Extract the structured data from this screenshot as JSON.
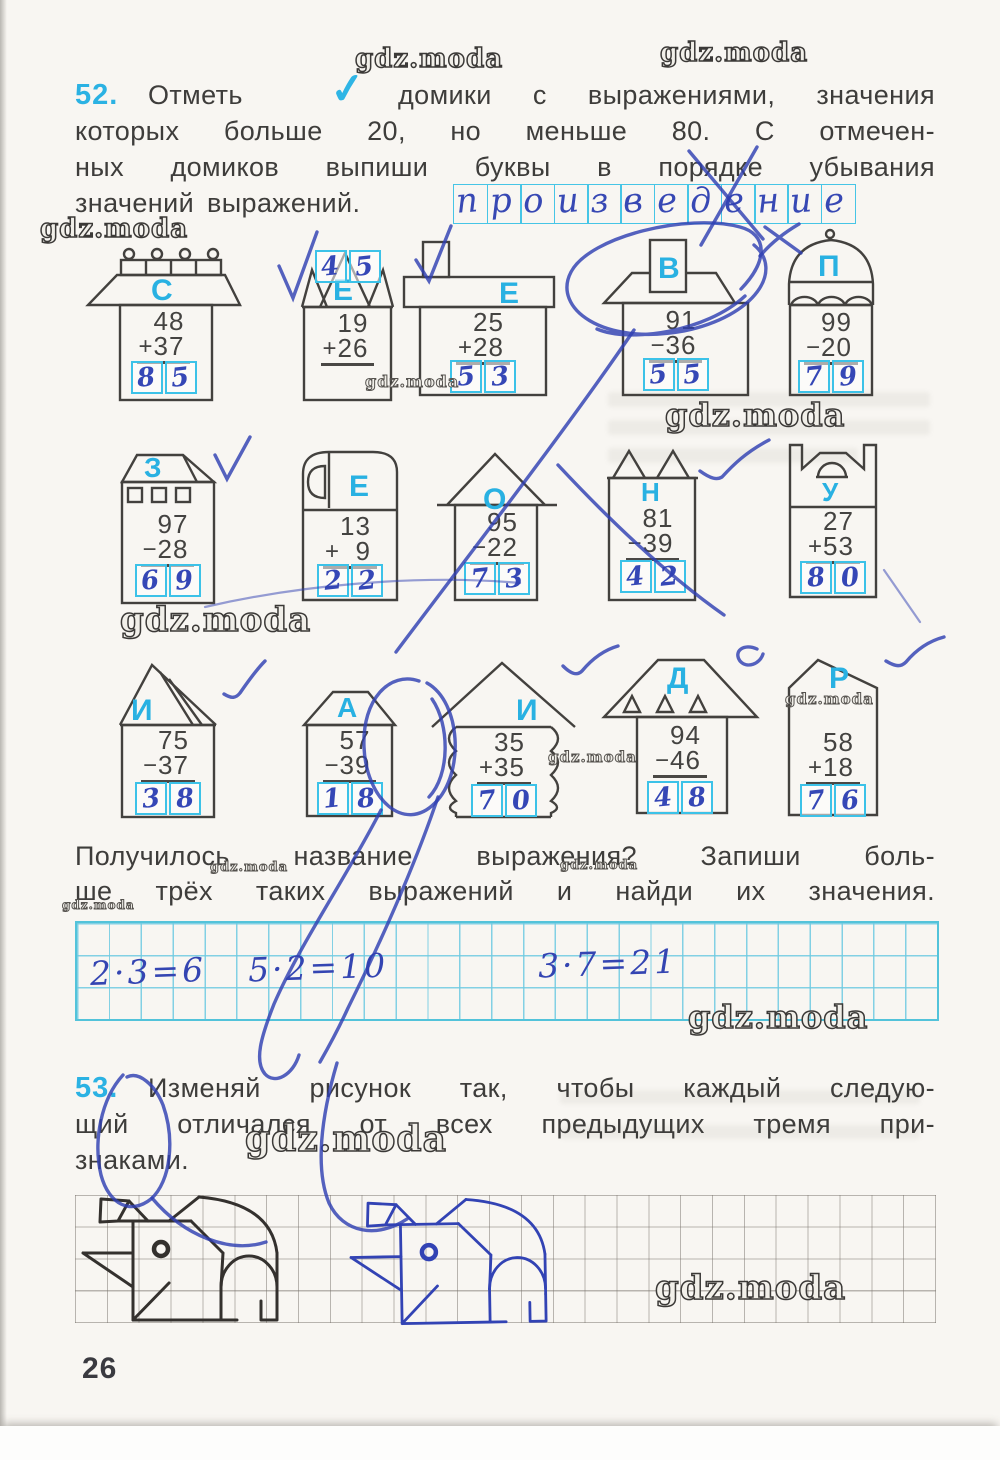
{
  "watermark": {
    "text": "gdz.moda"
  },
  "page": {
    "number": "26"
  },
  "task52": {
    "number": "52.",
    "word1": "Отметь",
    "check": "✓",
    "line1_rest": "домики с выражениями, значения",
    "line2": "которых больше 20, но меньше 80. С отмечен-",
    "line3": "ных домиков выпиши буквы в порядке убывания",
    "line4": "значений выражений.",
    "answer_letters": [
      "п",
      "р",
      "о",
      "и",
      "з",
      "в",
      "е",
      "д",
      "е",
      "н",
      "и",
      "е"
    ],
    "houses": [
      {
        "letter": "С",
        "sign": "+",
        "top": "48",
        "bottom": "37",
        "d1": "8",
        "d2": "5"
      },
      {
        "letter": "Е",
        "sign": "+",
        "top": "19",
        "bottom": "26",
        "d1": "4",
        "d2": "5"
      },
      {
        "letter": "Е",
        "sign": "+",
        "top": "25",
        "bottom": "28",
        "d1": "5",
        "d2": "3"
      },
      {
        "letter": "В",
        "sign": "−",
        "top": "91",
        "bottom": "36",
        "d1": "5",
        "d2": "5"
      },
      {
        "letter": "П",
        "sign": "−",
        "top": "99",
        "bottom": "20",
        "d1": "7",
        "d2": "9"
      },
      {
        "letter": "З",
        "sign": "−",
        "top": "97",
        "bottom": "28",
        "d1": "6",
        "d2": "9"
      },
      {
        "letter": "Е",
        "sign": "+",
        "top": "13",
        "bottom": "9",
        "d1": "2",
        "d2": "2"
      },
      {
        "letter": "О",
        "sign": "−",
        "top": "95",
        "bottom": "22",
        "d1": "7",
        "d2": "3"
      },
      {
        "letter": "Н",
        "sign": "−",
        "top": "81",
        "bottom": "39",
        "d1": "4",
        "d2": "2"
      },
      {
        "letter": "У",
        "sign": "+",
        "top": "27",
        "bottom": "53",
        "d1": "8",
        "d2": "0"
      },
      {
        "letter": "И",
        "sign": "−",
        "top": "75",
        "bottom": "37",
        "d1": "3",
        "d2": "8"
      },
      {
        "letter": "А",
        "sign": "−",
        "top": "57",
        "bottom": "39",
        "d1": "1",
        "d2": "8"
      },
      {
        "letter": "И",
        "sign": "+",
        "top": "35",
        "bottom": "35",
        "d1": "7",
        "d2": "0"
      },
      {
        "letter": "Д",
        "sign": "−",
        "top": "94",
        "bottom": "46",
        "d1": "4",
        "d2": "8"
      },
      {
        "letter": "Р",
        "sign": "+",
        "top": "58",
        "bottom": "18",
        "d1": "7",
        "d2": "6"
      }
    ],
    "followup1": "Получилось название выражения? Запиши боль-",
    "followup2": "ше трёх таких выражений и найди их значения.",
    "written": [
      "2·3=6",
      "5·2=10",
      "3·7=21"
    ]
  },
  "task53": {
    "number": "53.",
    "line1": "Изменяй рисунок так, чтобы каждый следую-",
    "line2": "щий отличался от всех предыдущих тремя при-",
    "line3": "знаками."
  }
}
